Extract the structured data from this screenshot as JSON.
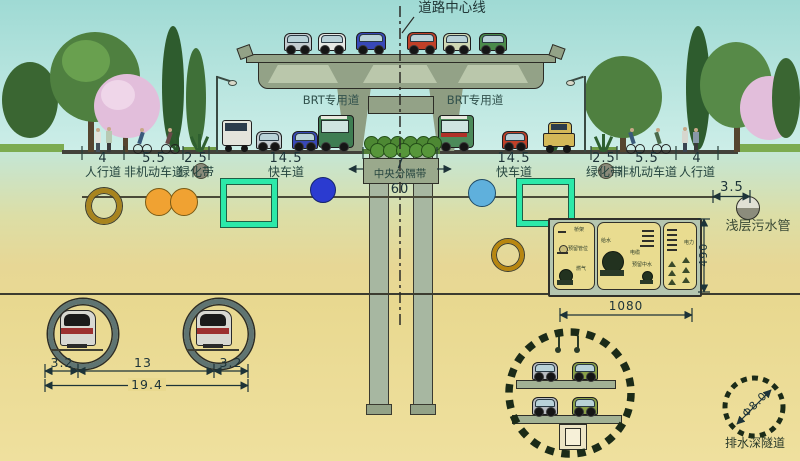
{
  "centerline": {
    "label": "道路中心线"
  },
  "viaduct": {
    "brt_left_label": "BRT专用道",
    "brt_right_label": "BRT专用道"
  },
  "section": {
    "dims": [
      "4",
      "5.5",
      "2.5",
      "14.5",
      "7",
      "14.5",
      "2.5",
      "5.5",
      "4"
    ],
    "labels": [
      "人行道",
      "非机动车道",
      "绿化带",
      "快车道",
      "中央分隔带",
      "快车道",
      "绿化带",
      "非机动车道",
      "人行道"
    ],
    "median_total": "60"
  },
  "sewer": {
    "dim": "3.5",
    "label": "浅层污水管"
  },
  "utility_tunnel": {
    "width_dim": "1080",
    "height_dim": "490",
    "gas_compartment": {
      "label_top": "桥架",
      "label_mid": "预留管位",
      "label_bottom": "燃气"
    },
    "water_compartment": {
      "label_top": "给水",
      "label_mid": "电缆",
      "label_bottom": "预留中水"
    },
    "power_compartment": {
      "label": "电力"
    }
  },
  "metro_tunnels": {
    "dim_left": "3.2",
    "dim_center": "13",
    "dim_right": "3.2",
    "dim_total": "19.4"
  },
  "deep_tunnel": {
    "diameter_label": "Φ8.0",
    "name_label": "排水深隧道"
  },
  "colors": {
    "sky": "#a2dcd6",
    "soil": "#e8d88f",
    "accent_box": "#2ce9a9",
    "pipe_orange": "#f0a232",
    "pipe_blue_dark": "#2b3bd0",
    "pipe_blue_light": "#5fb0dc"
  }
}
